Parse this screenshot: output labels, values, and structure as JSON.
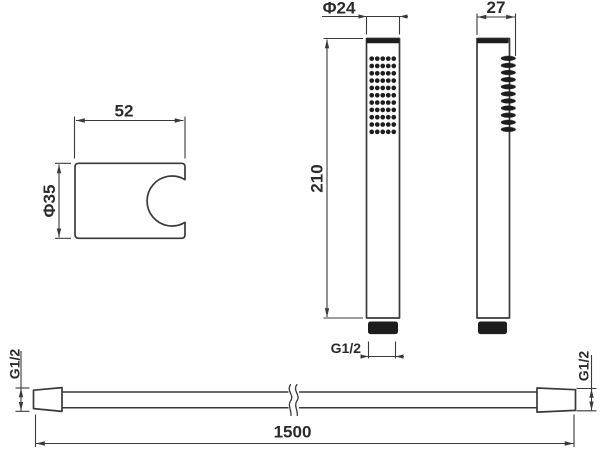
{
  "bracket": {
    "width_label": "52",
    "diameter_label": "Φ35"
  },
  "handset_front": {
    "head_diameter_label": "Φ24",
    "length_label": "210",
    "outlet_thread_label": "G1/2"
  },
  "handset_side": {
    "depth_label": "27"
  },
  "hose": {
    "length_label": "1500",
    "left_thread_label": "G1/2",
    "right_thread_label": "G1/2"
  },
  "colors": {
    "background": "#ffffff",
    "line": "#3a3a3a",
    "dark_fill": "#1d1d1d",
    "text": "#2b2b2b"
  }
}
